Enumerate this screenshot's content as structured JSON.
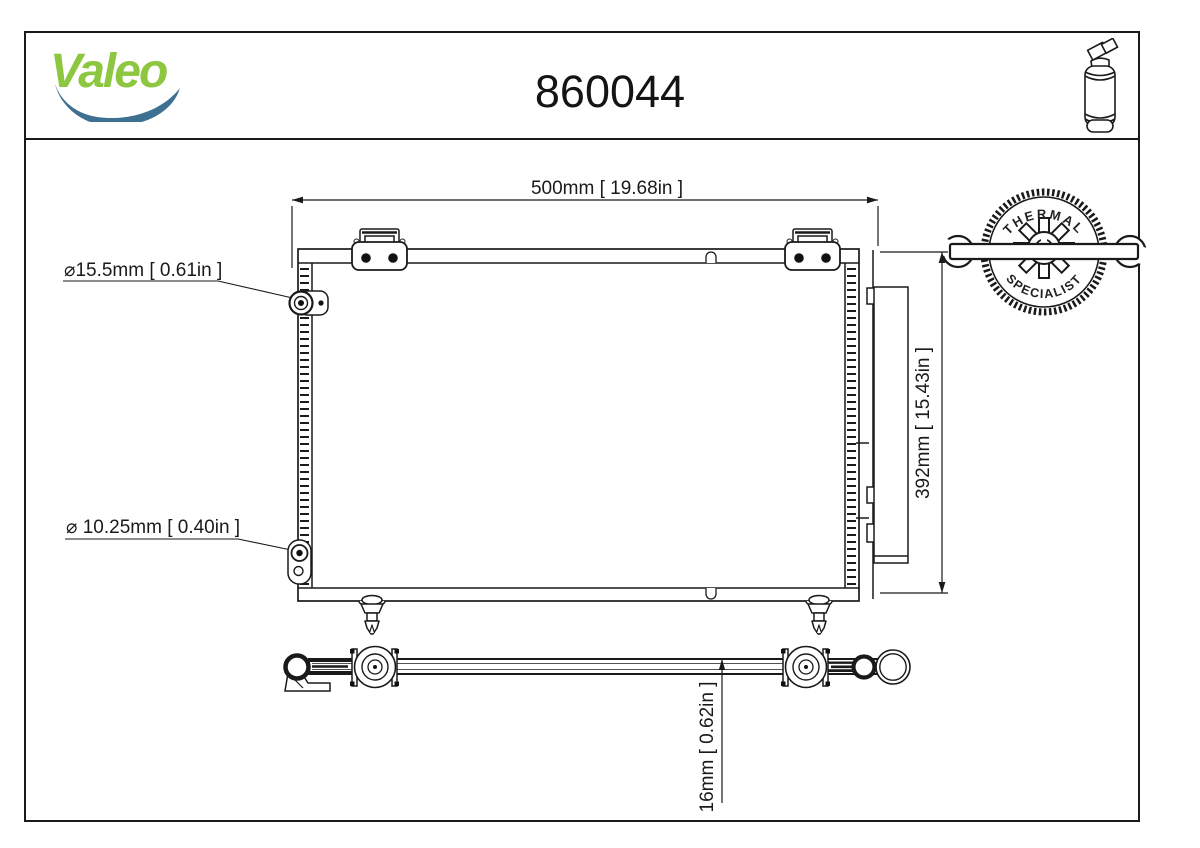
{
  "page": {
    "brand_logo": "Valeo",
    "part_number": "860044"
  },
  "badge": {
    "arc_top": "THERMAL",
    "arc_bottom": "SPECIALIST"
  },
  "dimensions": {
    "overall_width": "500mm [ 19.68in ]",
    "overall_height": "392mm [ 15.43in ]",
    "core_depth": "16mm [ 0.62in ]",
    "top_port_diameter": "⌀15.5mm [ 0.61in ]",
    "bottom_port_diameter": "⌀ 10.25mm [ 0.40in ]"
  },
  "colors": {
    "brand_green": "#8DC63F",
    "swoosh_blue": "#3E7091",
    "line_color": "#1a1a1a"
  }
}
